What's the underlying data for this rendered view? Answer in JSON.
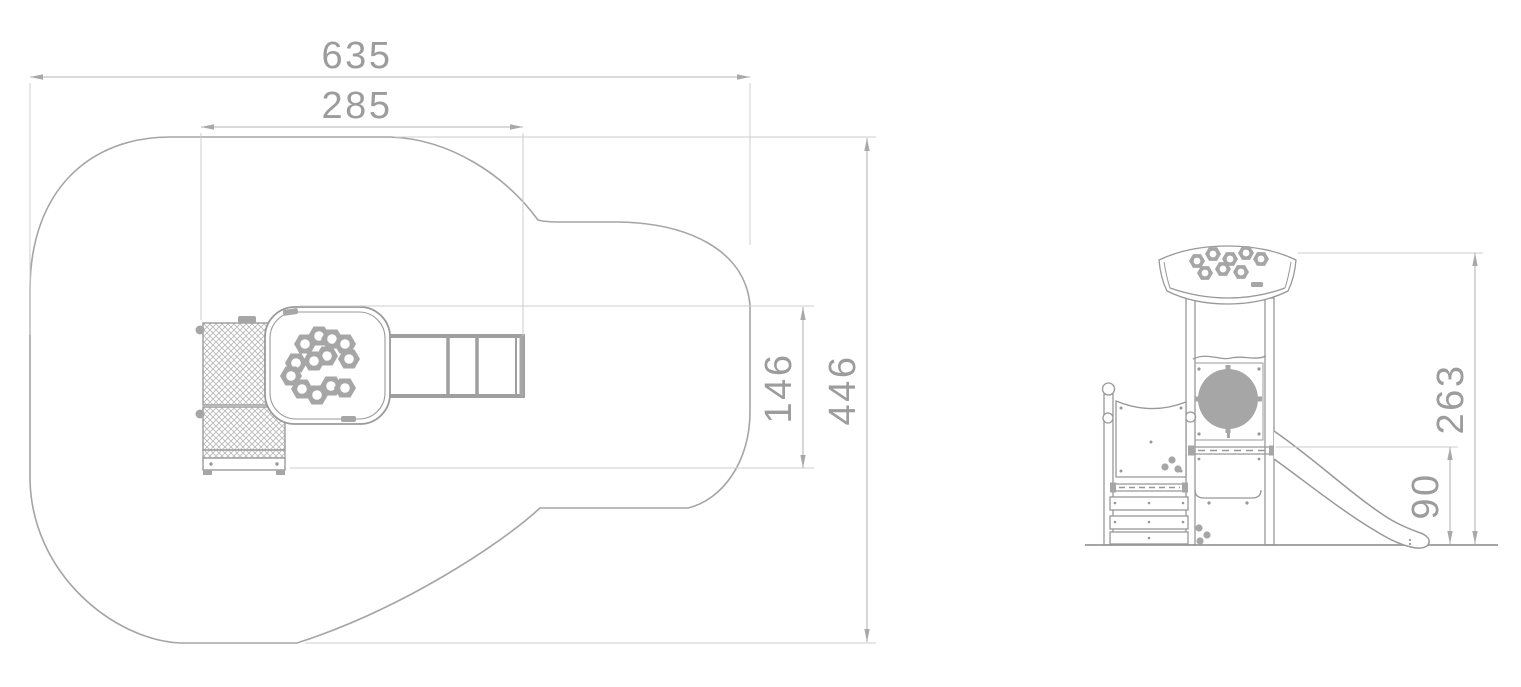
{
  "palette": {
    "line": "#989898",
    "gray_fill": "#a6a6a6",
    "dim_line": "#b5b5b5",
    "ext_line": "#cccccc",
    "text": "#9c9c9c",
    "background": "#ffffff"
  },
  "plan": {
    "total_width": "635",
    "equipment_width": "285",
    "equipment_depth": "146",
    "total_depth": "446"
  },
  "elevation": {
    "total_height": "263",
    "platform_height": "90"
  }
}
